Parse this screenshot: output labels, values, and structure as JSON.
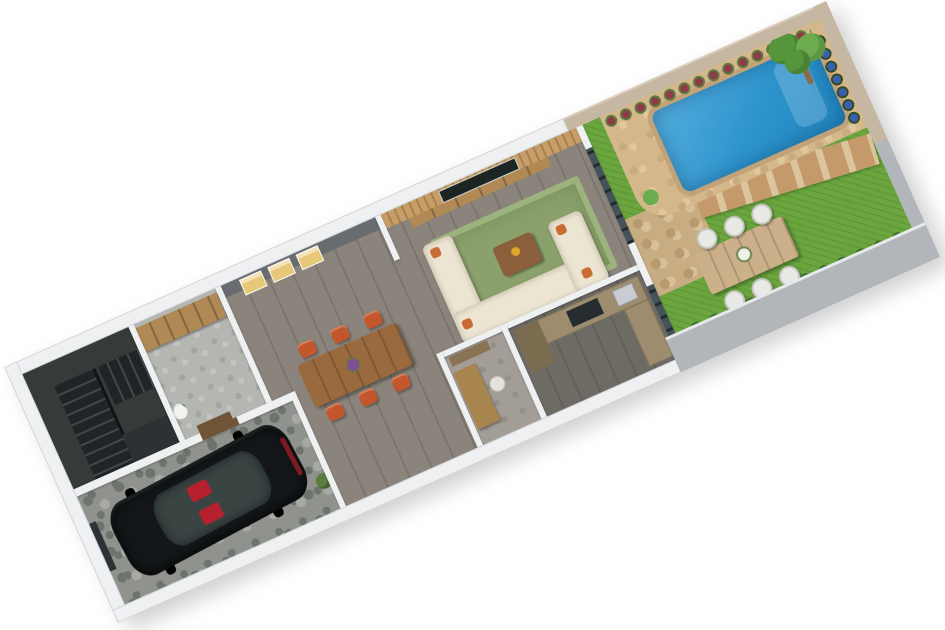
{
  "scene": {
    "type": "3d-isometric-floor-plan-render",
    "rooms": [
      {
        "id": "garage",
        "contents": [
          "black-sports-car",
          "cobblestone-floor",
          "wood-door"
        ]
      },
      {
        "id": "staircase-hall",
        "contents": [
          "u-shaped-dark-stairs",
          "landing",
          "flower-vase"
        ]
      },
      {
        "id": "entry-hall",
        "contents": [
          "wood-console",
          "entry-door"
        ]
      },
      {
        "id": "dining-area",
        "contents": [
          "wood-dining-table",
          "six-orange-chairs",
          "purple-centerpiece",
          "grey-feature-wall",
          "three-paintings"
        ]
      },
      {
        "id": "living-room",
        "contents": [
          "wood-slat-tv-wall",
          "tv",
          "media-console",
          "green-rug",
          "cream-sectional-sofa",
          "chaise",
          "orange-pillows",
          "coffee-table",
          "glass-sliding-doors"
        ]
      },
      {
        "id": "study",
        "contents": [
          "desk",
          "white-chair",
          "wall-shelf"
        ]
      },
      {
        "id": "kitchen",
        "contents": [
          "l-shaped-counter",
          "cooktop",
          "sink",
          "tall-cabinet"
        ]
      }
    ],
    "outdoor": [
      {
        "id": "garden",
        "contents": [
          "lawn",
          "outdoor-dining-table",
          "six-white-chairs",
          "stone-patio",
          "brick-step-path",
          "shrub-row"
        ]
      },
      {
        "id": "pool-area",
        "contents": [
          "swimming-pool",
          "tan-pool-deck",
          "red-flower-border",
          "blue-flower-strip",
          "corner-tree",
          "potted-plant"
        ]
      }
    ]
  },
  "palette": {
    "bg": "#ffffff",
    "wall-outer": "#eef0f2",
    "wall-edge": "#d3d6da",
    "wall-inner-grey": "#686b70",
    "wall-garden-top": "#c6b7a3",
    "wall-garden-bottom": "#b2b6bb",
    "floor-wood": "#8b847c",
    "floor-wood-line": "#7c756e",
    "floor-cobble": "#8f928d",
    "floor-cobble-dark": "#6f736e",
    "floor-cobble-light": "#a7aaa3",
    "floor-stair": "#363b39",
    "stair-step": "#1f2426",
    "stair-step-edge": "#424849",
    "floor-entry": "#b4b6b1",
    "floor-study": "#a29d96",
    "floor-kitchen": "#6e6a64",
    "painting": "#e7c878",
    "tv-slat": "#c79e67",
    "tv-slat-dark": "#a87f4f",
    "tv-screen": "#1c2522",
    "console-wood": "#b08954",
    "rug": "#8ba16c",
    "rug-line": "#9db37d",
    "sofa": "#ece5d2",
    "sofa-edge": "#d8d0bb",
    "pillow": "#c96b35",
    "table-wood": "#9a6a3e",
    "chair-orange": "#c4562b",
    "centerpiece": "#7d4f93",
    "desk-wood": "#a8844f",
    "counter-wood": "#9d8c6d",
    "cabinet-wood": "#7b6c50",
    "cooktop": "#262c30",
    "sink": "#c9ccd0",
    "glass": "#45525a",
    "grass": "#6aa53e",
    "grass-dark": "#5c9434",
    "deck": "#d4b88c",
    "deck-edge": "#c2a276",
    "pool": "#2d93cc",
    "pool-light": "#55aedd",
    "patio": "#c8ad83",
    "step-brick": "#c59a6b",
    "step-gap": "#dcc49e",
    "flower-red": "#8e3b47",
    "flower-leaf": "#5b7d42",
    "flower-blue": "#3b5fae",
    "tree-green": "#55953c",
    "tree-green-light": "#6cab4e",
    "trunk": "#8a6a4a",
    "car-body": "#141719",
    "car-glass": "#394443",
    "car-seat": "#b7212e",
    "outdoor-table": "#cbb089",
    "outdoor-chair": "#e9e9e6",
    "door-wood": "#6f5436",
    "shrub": "#3e6b2f"
  }
}
